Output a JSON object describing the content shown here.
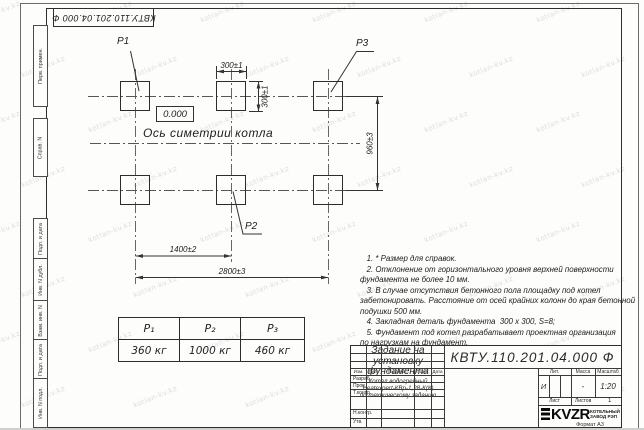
{
  "watermark": {
    "text": "kotlan-kv.kz"
  },
  "stamp_top": {
    "text": "КВТУ.110.201.04.000  Ф"
  },
  "sidebar": {
    "items": [
      {
        "label": "Перв. примен."
      },
      {
        "label": "Справ. N"
      },
      {
        "label": "Подп. и дата"
      },
      {
        "label": "Инв. N дубл."
      },
      {
        "label": "Взам. инв. N"
      },
      {
        "label": "Подп. и дата"
      },
      {
        "label": "Инв. N подл."
      }
    ]
  },
  "drawing": {
    "pad_labels": {
      "p1": "P1",
      "p2": "P2",
      "p3": "P3"
    },
    "elevation": "0.000",
    "axis_label": "Ось симетрии котла",
    "dims": {
      "w300": "300±1",
      "h300": "300±1",
      "v960": "960±3",
      "h1400": "1400±2",
      "h2800": "2800±3"
    }
  },
  "load_table": {
    "headers": [
      "P₁",
      "P₂",
      "P₃"
    ],
    "values": [
      "360 кг",
      "1000 кг",
      "460 кг"
    ]
  },
  "notes": {
    "lines": [
      "   1. * Размер для справок.",
      "   2. Отклонение от горизонтального уровня верхней поверхности",
      "фундамента не более 10 мм.",
      "   3. В случае отсутствия бетонного пола площадку под котел",
      "забетонировать. Расстояние от осей крайних колонн до края бетонной",
      "подушки 500 мм.",
      "   4. Закладная деталь фундамента  300 х 300, S=8;",
      "   5. Фундамент под котел разрабатывает проектная организация",
      "по нагрузкам на фундамент."
    ]
  },
  "title_block": {
    "doc_number": "КВТУ.110.201.04.000  Ф",
    "title_lines": [
      "Задание на",
      "установку",
      "фундамента"
    ],
    "subtitle_lines": [
      "Котел водогрейный",
      "Heatexpert-КВр-1,28-К(К)",
      "по техническому заданию"
    ],
    "cols": {
      "izm": "Изм.",
      "list": "Лист",
      "ndoc": "N докум.",
      "podp": "Подп.",
      "data": "Дата"
    },
    "rows": [
      "Разраб.",
      "Пров.",
      "Т.контр.",
      "Н.контр.",
      "Утв."
    ],
    "lit_label": "Лит.",
    "mass_label": "Масса",
    "scale_label": "Масштаб",
    "lit_value": "И",
    "mass_value": "-",
    "scale_value": "1:20",
    "sheet_label": "Лист",
    "sheets_label": "Листов",
    "sheets_value": "1",
    "logo_text": "KVZR",
    "logo_sub1": "КОТЕЛЬНЫЙ",
    "logo_sub2": "ЗАВОД РЭП",
    "format_label": "Формат А3"
  }
}
